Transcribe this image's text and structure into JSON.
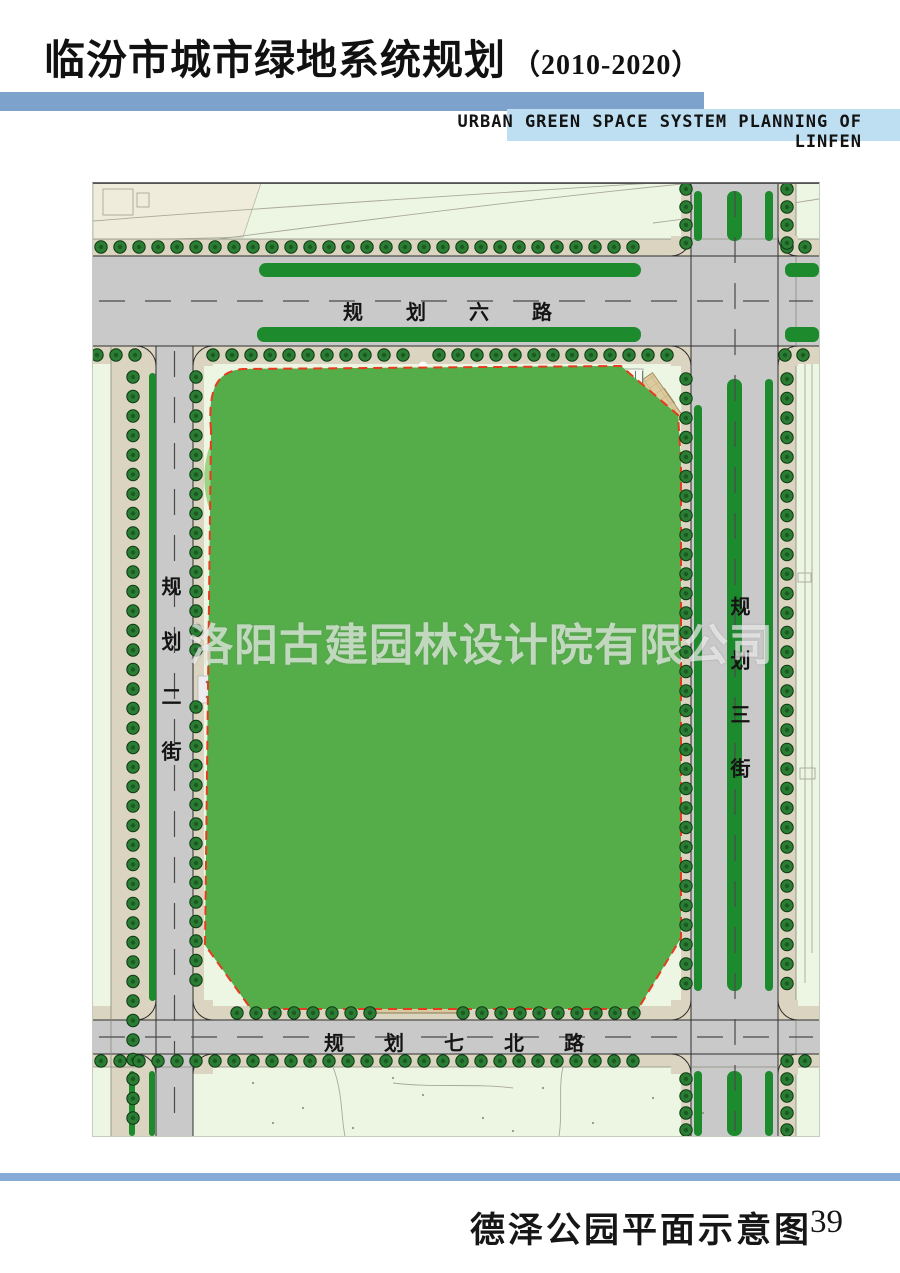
{
  "header": {
    "title": "临汾市城市绿地系统规划",
    "period": "（2010-2020）",
    "subtitle_en": "URBAN GREEN SPACE SYSTEM PLANNING OF LINFEN",
    "accent_bar_color": "#7da3cd",
    "subtitle_band_color": "#bedff2"
  },
  "map": {
    "roads": {
      "north": "规划六路",
      "south": "规划七北路",
      "west": "规划二街",
      "east": "规划三街"
    },
    "watermark": "洛阳古建园林设计院有限公司",
    "park_boundary_color": "#e63b1e",
    "park_green": "#55ad4a",
    "road_gray": "#c9c9c9"
  },
  "footer": {
    "caption": "德泽公园平面示意图",
    "page": "39",
    "rule_color": "#85abd6"
  }
}
